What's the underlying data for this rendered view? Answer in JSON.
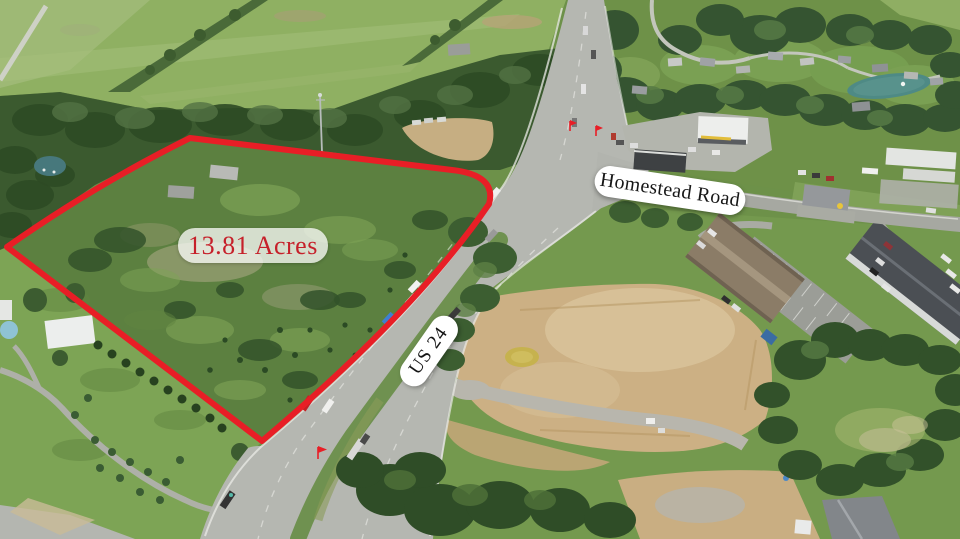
{
  "annotations": {
    "acreage_label": "13.81 Acres",
    "homestead_road_label": "Homestead Road",
    "us24_label": "US 24"
  },
  "colors": {
    "boundary_red": "#e81e26",
    "acreage_text": "#c6202a",
    "label_pill": "#ffffff",
    "label_text": "#161616"
  }
}
